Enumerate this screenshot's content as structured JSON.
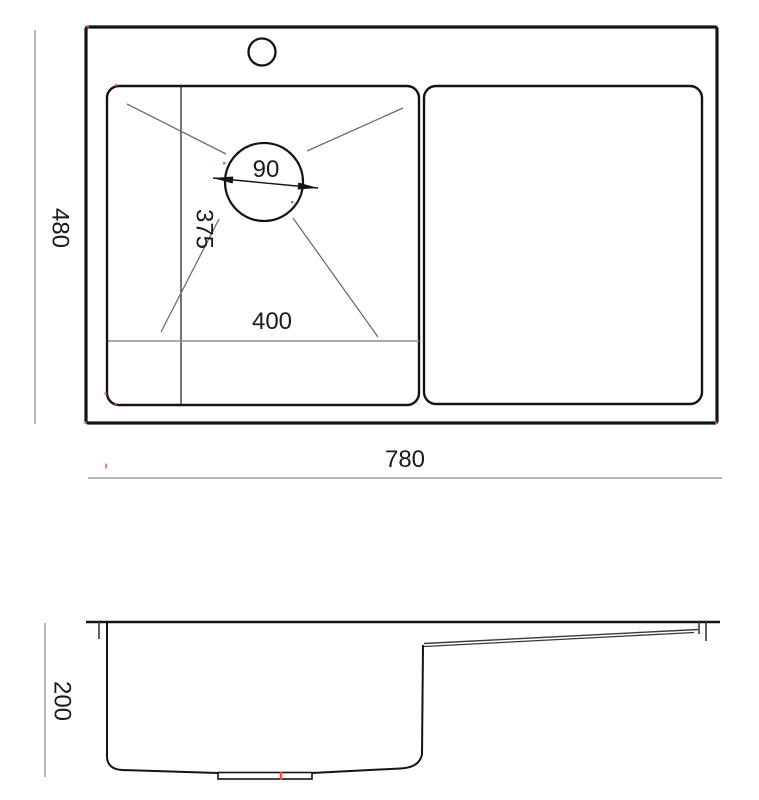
{
  "canvas": {
    "width": 759,
    "height": 800,
    "background": "#ffffff"
  },
  "colors": {
    "object_line": "#141414",
    "interior_line": "#3a3a3a",
    "guide_line": "#6e6e6e",
    "dim_line": "#8e8e8e",
    "text_color": "#1a1a1a",
    "accent_red": "#f0503c"
  },
  "dimensions": {
    "overall_width": "780",
    "overall_depth": "480",
    "bowl_inner_width": "400",
    "bowl_inner_depth": "375",
    "drain_hole_diameter": "90",
    "sink_height": "200"
  }
}
